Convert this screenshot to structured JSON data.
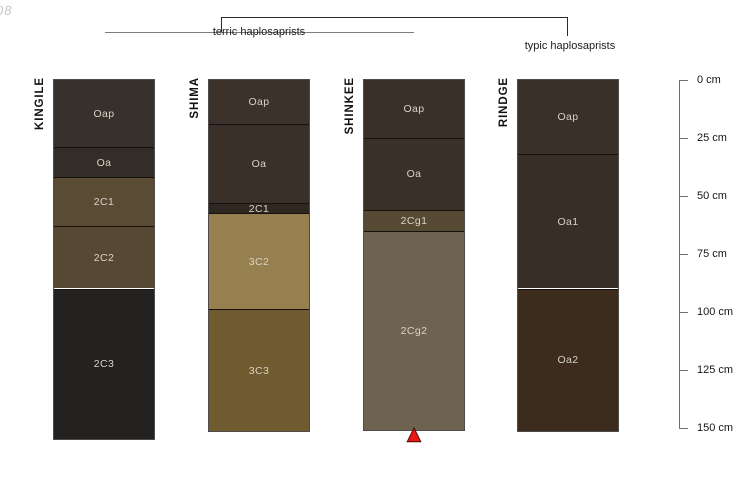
{
  "watermark": "08",
  "groups": {
    "terric_label": "terric haplosaprists",
    "typic_label": "typic haplosaprists"
  },
  "depth_scale": {
    "unit": "cm",
    "ticks": [
      {
        "cm": 0,
        "label": "0 cm"
      },
      {
        "cm": 25,
        "label": "25 cm"
      },
      {
        "cm": 50,
        "label": "50 cm"
      },
      {
        "cm": 75,
        "label": "75 cm"
      },
      {
        "cm": 100,
        "label": "100 cm"
      },
      {
        "cm": 125,
        "label": "125 cm"
      },
      {
        "cm": 150,
        "label": "150 cm"
      }
    ]
  },
  "marker": {
    "symbol": "triangle-up",
    "fill_color": "#ee1515",
    "outline_color": "#4a0d0d",
    "below_profile": "SHINKEE"
  },
  "chart_data": {
    "type": "soil-profile-columns",
    "y_axis": {
      "label_unit": "cm",
      "min": 0,
      "max": 150
    },
    "profiles": [
      {
        "name": "KINGILE",
        "group": "terric haplosaprists",
        "bottom_cm": 155,
        "horizons": [
          {
            "label": "Oap",
            "top_cm": 0,
            "bottom_cm": 29,
            "color": "#38302a"
          },
          {
            "label": "Oa",
            "top_cm": 29,
            "bottom_cm": 42,
            "color": "#342c26"
          },
          {
            "label": "2C1",
            "top_cm": 42,
            "bottom_cm": 63,
            "color": "#5a4c34"
          },
          {
            "label": "2C2",
            "top_cm": 63,
            "bottom_cm": 90,
            "color": "#564833"
          },
          {
            "label": "2C3",
            "top_cm": 90,
            "bottom_cm": 155,
            "color": "#242220"
          }
        ]
      },
      {
        "name": "SHIMA",
        "group": "terric haplosaprists",
        "bottom_cm": 151.5,
        "horizons": [
          {
            "label": "Oap",
            "top_cm": 0,
            "bottom_cm": 19,
            "color": "#3a322b"
          },
          {
            "label": "Oa",
            "top_cm": 19,
            "bottom_cm": 53,
            "color": "#3a3029"
          },
          {
            "label": "2C1",
            "top_cm": 53,
            "bottom_cm": 57.5,
            "color": "#2f2821"
          },
          {
            "label": "3C2",
            "top_cm": 57.5,
            "bottom_cm": 99,
            "color": "#97804f"
          },
          {
            "label": "3C3",
            "top_cm": 99,
            "bottom_cm": 151.5,
            "color": "#6f5b2f"
          }
        ]
      },
      {
        "name": "SHINKEE",
        "group": "terric haplosaprists",
        "bottom_cm": 151,
        "horizons": [
          {
            "label": "Oap",
            "top_cm": 0,
            "bottom_cm": 25,
            "color": "#3a3028"
          },
          {
            "label": "Oa",
            "top_cm": 25,
            "bottom_cm": 56,
            "color": "#393028"
          },
          {
            "label": "2Cg1",
            "top_cm": 56,
            "bottom_cm": 65,
            "color": "#564a35"
          },
          {
            "label": "2Cg2",
            "top_cm": 65,
            "bottom_cm": 151,
            "color": "#6e6350"
          }
        ]
      },
      {
        "name": "RINDGE",
        "group": "typic haplosaprists",
        "bottom_cm": 151.5,
        "horizons": [
          {
            "label": "Oap",
            "top_cm": 0,
            "bottom_cm": 32,
            "color": "#393028"
          },
          {
            "label": "Oa1",
            "top_cm": 32,
            "bottom_cm": 90,
            "color": "#362e27"
          },
          {
            "label": "Oa2",
            "top_cm": 90,
            "bottom_cm": 151.5,
            "color": "#3b2c1d"
          }
        ]
      }
    ]
  }
}
